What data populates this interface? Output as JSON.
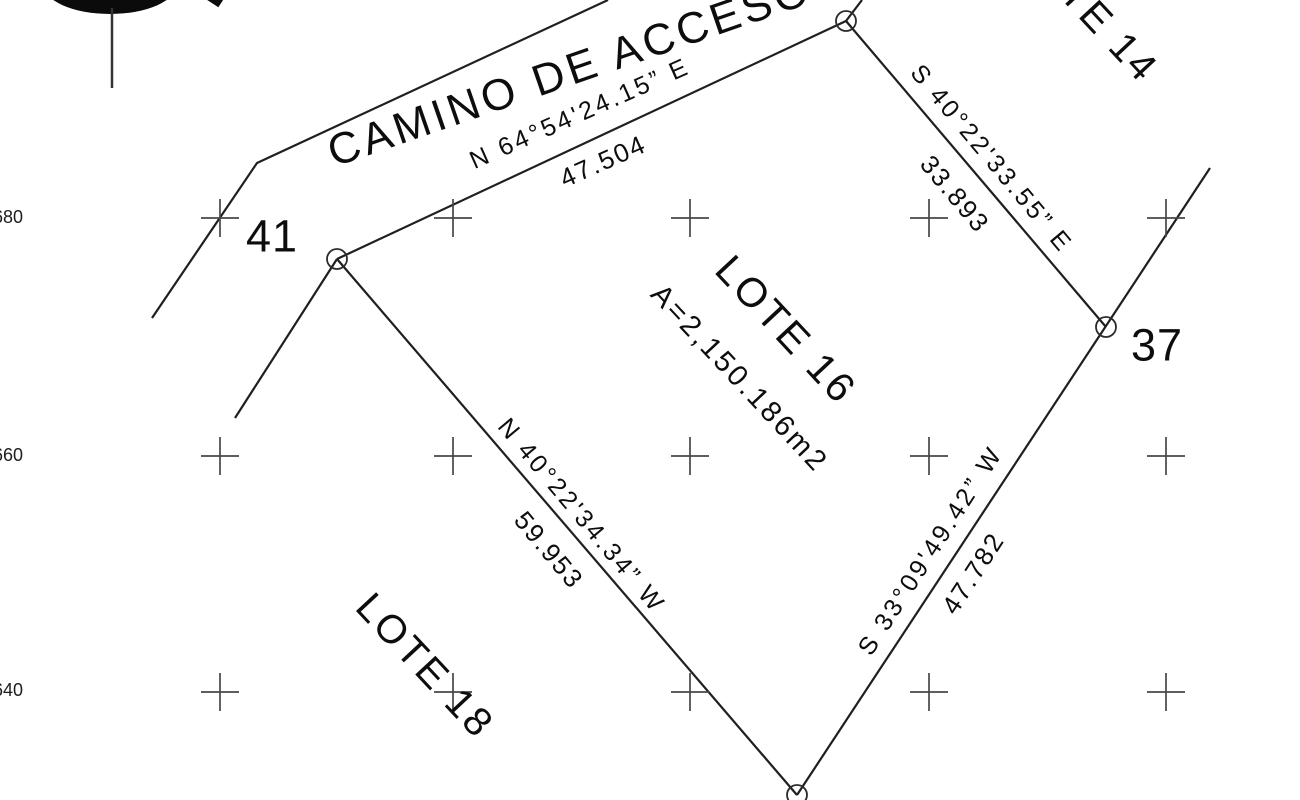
{
  "map": {
    "road_label": "CAMINO DE ACCESO",
    "lot": {
      "name": "LOTE 16",
      "area": "A=2,150.186m2"
    },
    "adjacent_lots": {
      "lote14": "LOTE 14",
      "lote18": "LOTE 18"
    },
    "point_labels": {
      "p41": "41",
      "p37": "37"
    },
    "boundaries": {
      "north": {
        "bearing": "N 64°54'24.15” E",
        "distance": "47.504"
      },
      "east_upper": {
        "bearing": "S 40°22'33.55” E",
        "distance": "33.893"
      },
      "east_lower": {
        "bearing": "S 33°09'49.42” W",
        "distance": "47.782"
      },
      "west": {
        "bearing": "N 40°22'34.34” W",
        "distance": "59.953"
      }
    },
    "grid": {
      "row_labels": [
        "680",
        "660",
        "640"
      ],
      "cols": [
        220,
        453,
        690,
        929,
        1166
      ],
      "rows": [
        218,
        456,
        692
      ],
      "cross_half": 19,
      "color": "#474747"
    },
    "colors": {
      "ink": "#1f1f1f",
      "text": "#0d0d0d"
    }
  }
}
